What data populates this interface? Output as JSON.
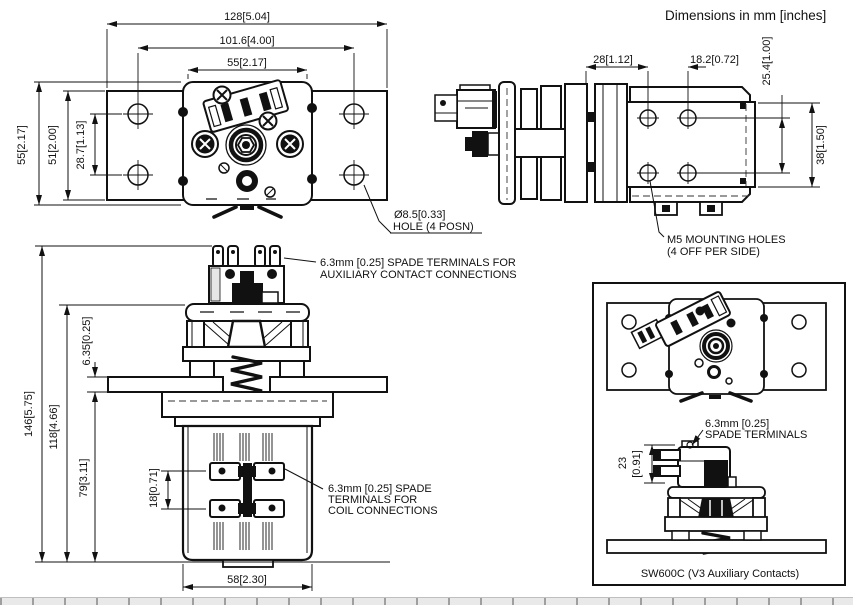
{
  "header": {
    "units_note": "Dimensions in mm [inches]"
  },
  "top_view": {
    "dim_width_overall": "128[5.04]",
    "dim_hole_spacing_h": "101.6[4.00]",
    "dim_body_width": "55[2.17]",
    "dim_height_overall": "55[2.17]",
    "dim_plate_height": "51[2.00]",
    "dim_hole_spacing_v": "28.7[1.13]",
    "hole_note_line1": "Ø8.5[0.33]",
    "hole_note_line2": "HOLE (4 POSN)"
  },
  "side_view": {
    "dim_body_to_hole": "28[1.12]",
    "dim_hole_spacing_h": "18.2[0.72]",
    "dim_hole_spacing_v": "25.4[1.00]",
    "dim_bracket_height": "38[1.50]",
    "mounting_note_line1": "M5 MOUNTING HOLES",
    "mounting_note_line2": "(4 OFF PER SIDE)"
  },
  "front_view": {
    "dim_height_overall": "146[5.75]",
    "dim_height_body": "118[4.66]",
    "dim_flange_thickness": "6.35[0.25]",
    "dim_height_under_flange": "79[3.11]",
    "dim_coil_terminal_spacing": "18[0.71]",
    "dim_base_width": "58[2.30]",
    "aux_terminal_note_line1": "6.3mm [0.25] SPADE TERMINALS FOR",
    "aux_terminal_note_line2": "AUXILIARY CONTACT CONNECTIONS",
    "coil_terminal_note_line1": "6.3mm [0.25] SPADE",
    "coil_terminal_note_line2": "TERMINALS FOR",
    "coil_terminal_note_line3": "COIL CONNECTIONS"
  },
  "aux_view": {
    "spade_note_line1": "6.3mm [0.25]",
    "spade_note_line2": "SPADE TERMINALS",
    "dim_switch_height_mm": "23",
    "dim_switch_height_in": "[0.91]",
    "caption": "SW600C (V3 Auxiliary Contacts)"
  }
}
